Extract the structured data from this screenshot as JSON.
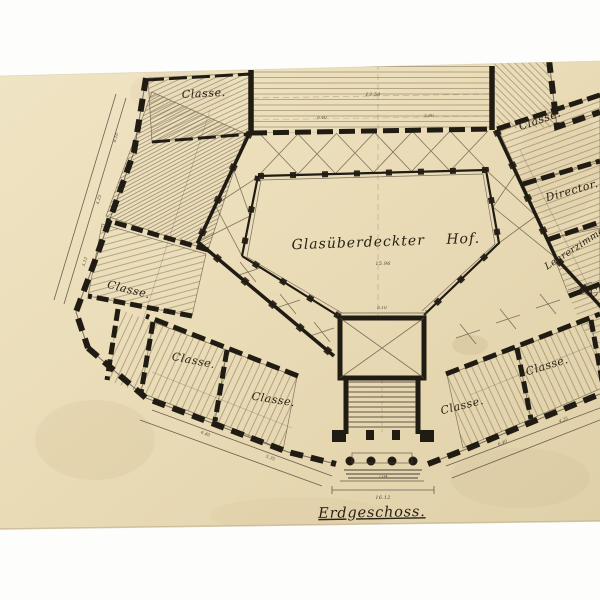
{
  "artwork": {
    "floor_label": "Erdgeschoss.",
    "courtyard_label": "Glasüberdeckter Hof.",
    "courtyard_value": "15.96"
  },
  "rooms": {
    "classe_top_left": "Classe.",
    "classe_north_east": "Classe.",
    "director": "Director.",
    "lehrerzimmer": "Lehrerzimmer.",
    "classe_right_edge": "Classe.",
    "classe_south_east_far": "Classe.",
    "classe_south_east_near": "Classe.",
    "classe_south_west_near": "Classe.",
    "classe_south_west_far": "Classe.",
    "classe_west": "Classe."
  },
  "dimensions": {
    "hall_width": "13.50",
    "hall_left": "6.40",
    "hall_right": "5.80",
    "west_a": "5.12",
    "west_b": "4.25",
    "west_c": "8.10",
    "sw_a": "6.40",
    "sw_b": "5.35",
    "se_a": "6.40",
    "se_b": "4.25",
    "court_width": "8.10",
    "porch_width": "7.04",
    "entrance_width": "16.12"
  },
  "colors": {
    "paper": "#e9dcb8",
    "ink": "#211c13",
    "white_margin": "#fdfdfc",
    "hatch": "#86765a"
  }
}
